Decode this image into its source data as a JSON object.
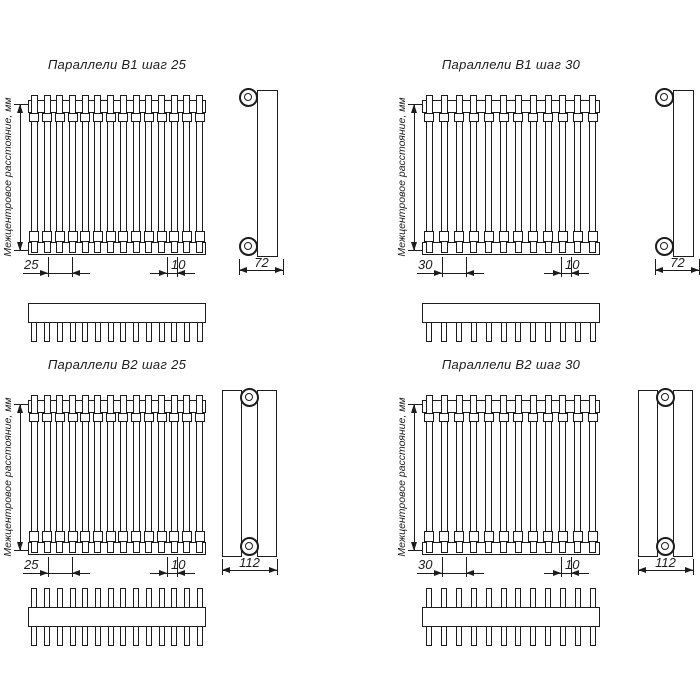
{
  "colors": {
    "background": "#ffffff",
    "line": "#1c1c1c"
  },
  "vertical_axis_label": "Межцентровое расстояние, мм",
  "drawings": [
    {
      "title": "Параллели В1 шаг 25",
      "tube_count": 14,
      "rows": 1,
      "pitch_dim": "25",
      "gap_dim": "10",
      "depth_dim": "72"
    },
    {
      "title": "Параллели В1 шаг 30",
      "tube_count": 12,
      "rows": 1,
      "pitch_dim": "30",
      "gap_dim": "10",
      "depth_dim": "72"
    },
    {
      "title": "Параллели В2 шаг 25",
      "tube_count": 14,
      "rows": 2,
      "pitch_dim": "25",
      "gap_dim": "10",
      "depth_dim": "112"
    },
    {
      "title": "Параллели В2 шаг 30",
      "tube_count": 12,
      "rows": 2,
      "pitch_dim": "30",
      "gap_dim": "10",
      "depth_dim": "112"
    }
  ]
}
